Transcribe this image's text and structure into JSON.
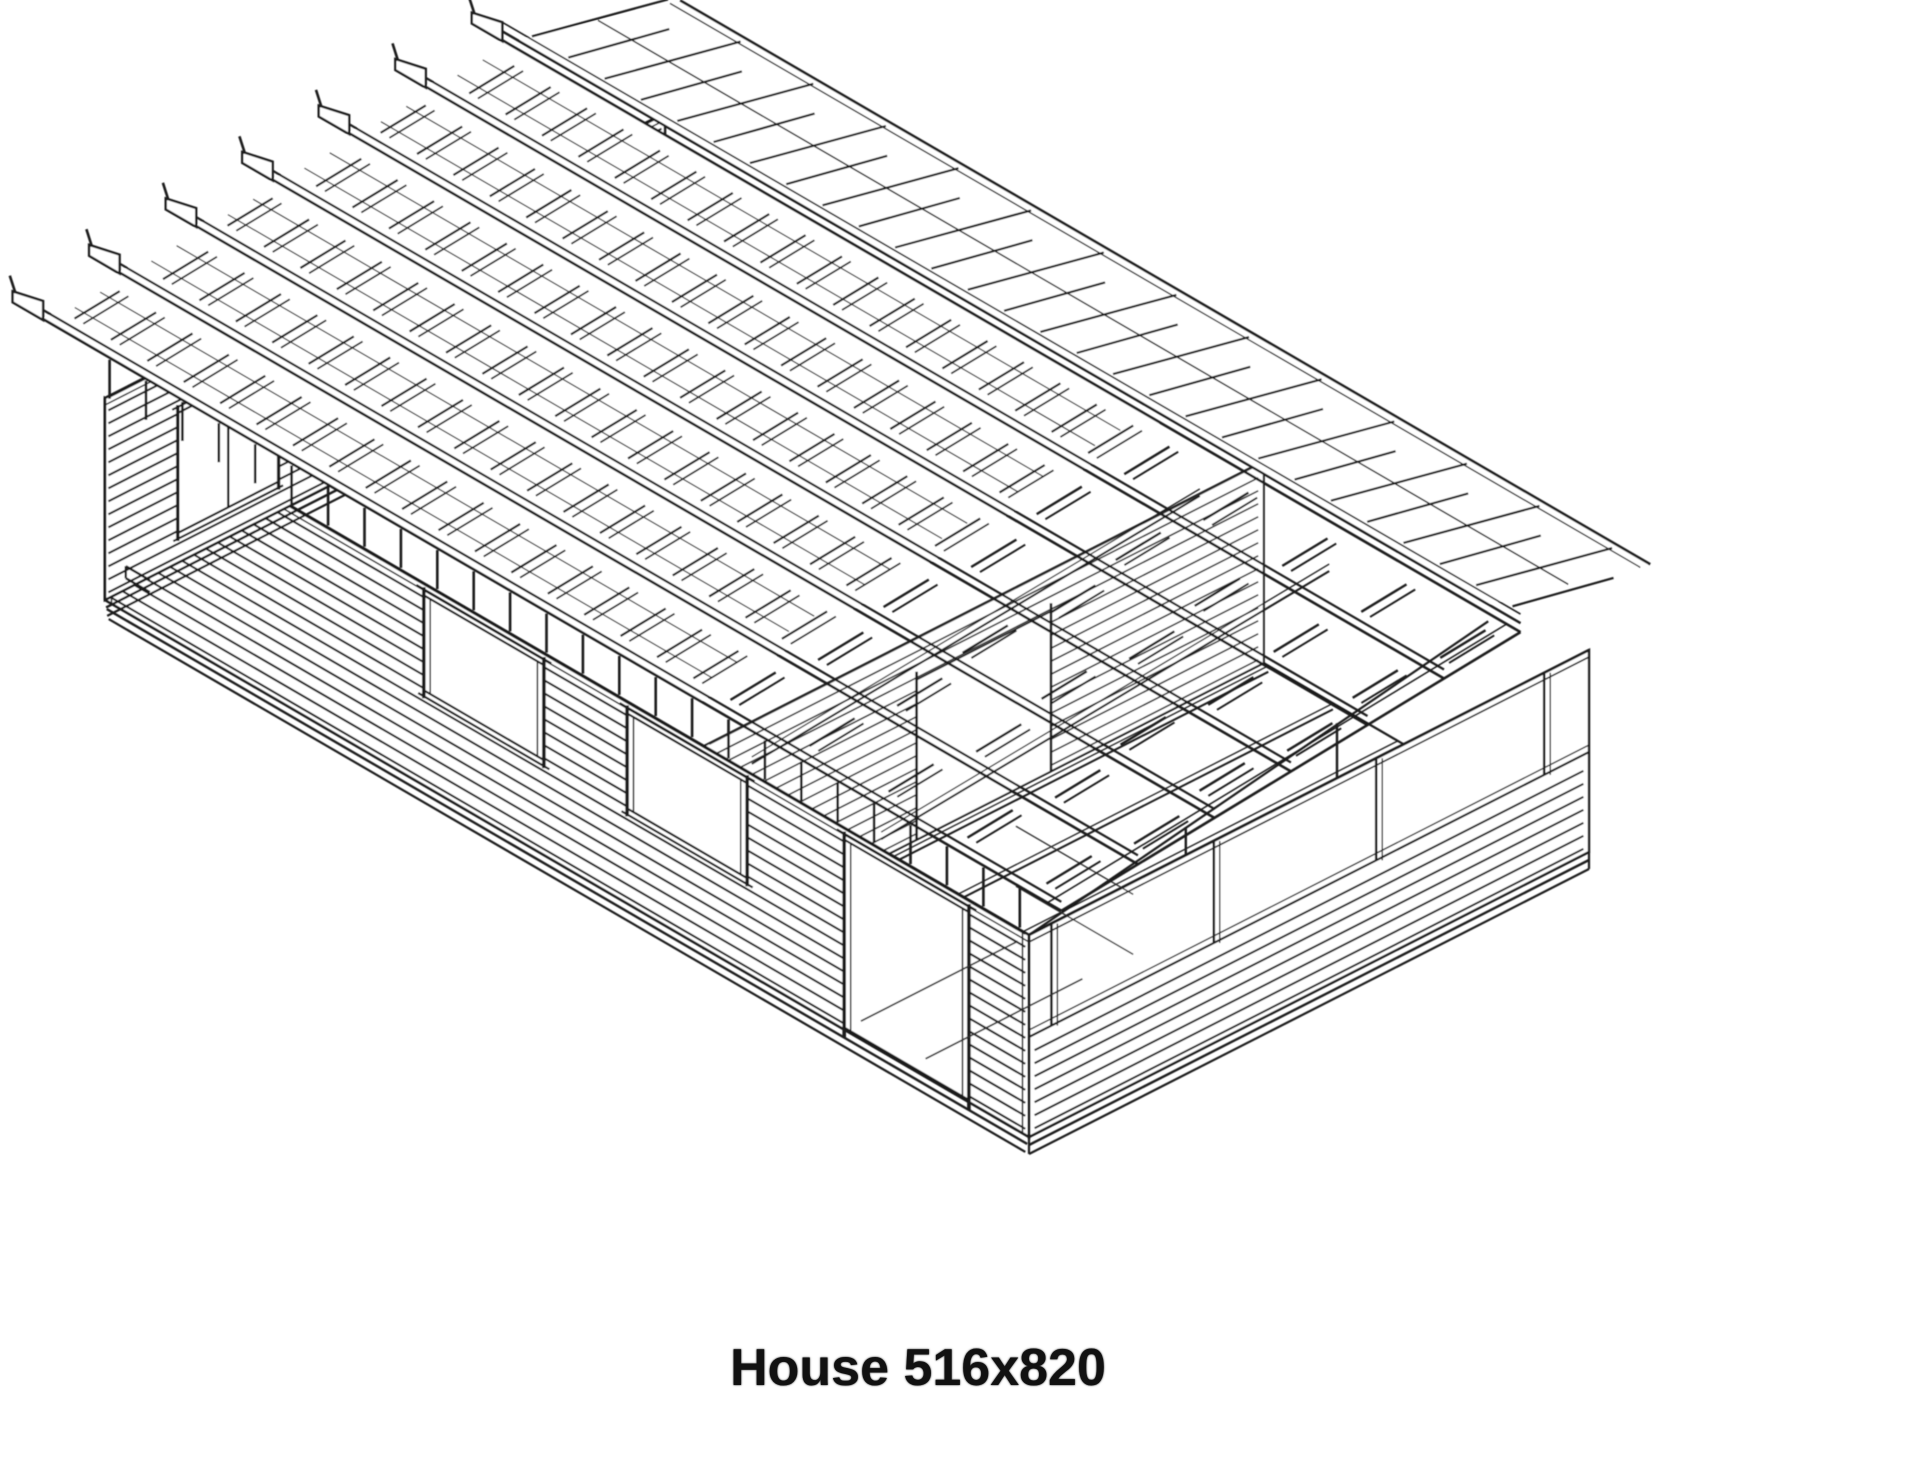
{
  "page": {
    "width_px": 1920,
    "height_px": 1462,
    "paper_color": "#ffffff"
  },
  "caption": {
    "text": "House 516x820"
  },
  "drawing": {
    "description": "Black-and-white isometric CAD wireframe of a log house kit with exposed roof purlins and battens, log walls, window and door openings, and an open terrace bay",
    "ink_color": "#1a1a1a",
    "faint_ink_color": "#2d2d2d",
    "house": {
      "footprint_label_cm": "516x820",
      "purlins_per_slope": 7,
      "log_courses_per_wall": 15,
      "roof_battens_boarded_section": 18,
      "roof_battens_open_section": 5,
      "floor_joists_terrace": 5,
      "ceiling_collar_beams": 2
    },
    "openings": {
      "front_windows": [
        {
          "t": [
            0.345,
            0.475
          ],
          "h": [
            95,
            190
          ]
        },
        {
          "t": [
            0.565,
            0.695
          ],
          "h": [
            95,
            190
          ]
        }
      ],
      "front_door": {
        "t": [
          0.8,
          0.935
        ],
        "h": [
          0,
          190
        ]
      },
      "gable_window": {
        "w": [
          0.13,
          0.31
        ],
        "h": [
          30,
          150
        ]
      },
      "interior_wall_opening": {
        "w": [
          0.38,
          0.62
        ],
        "h": [
          0,
          160
        ]
      }
    }
  }
}
